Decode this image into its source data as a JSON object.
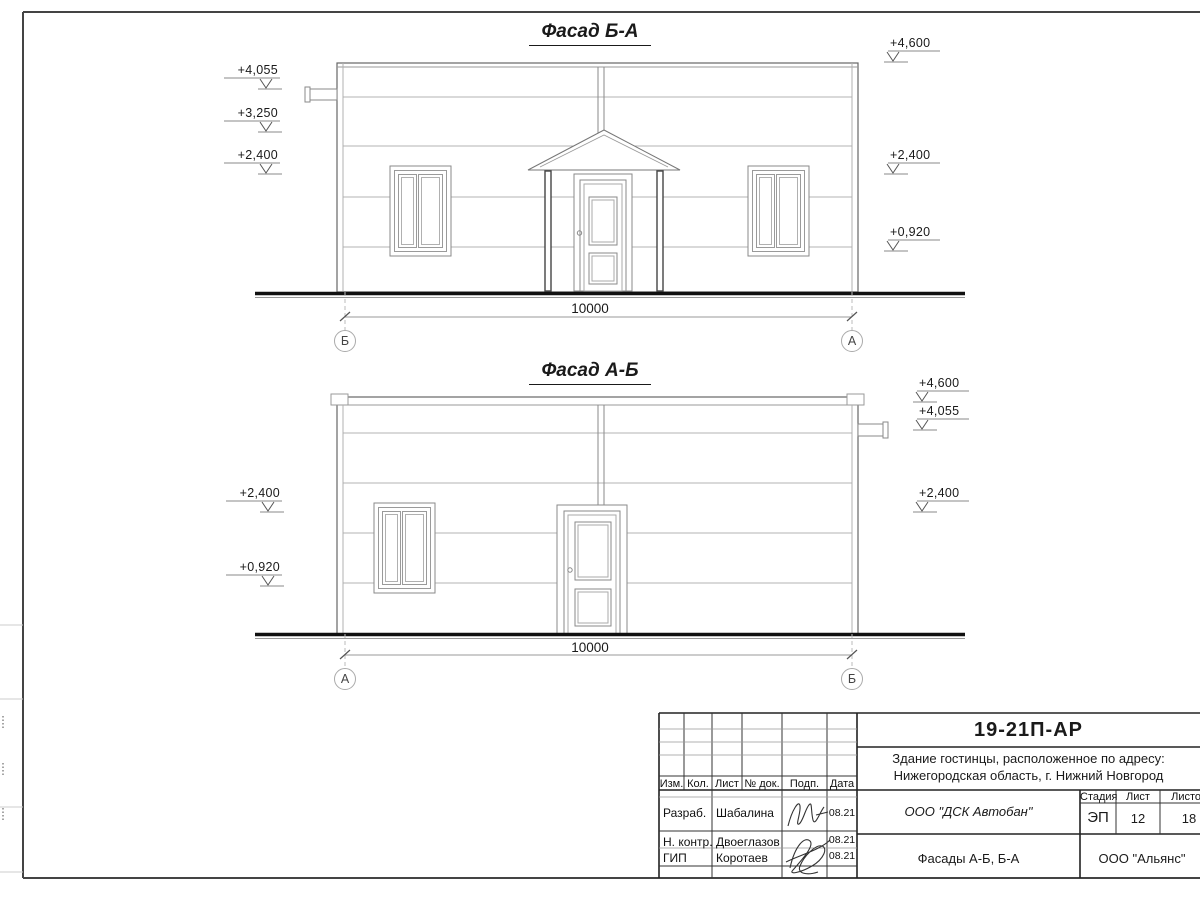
{
  "colors": {
    "ink": "#1a1a1a",
    "frame": "#444444",
    "siding_line": "#b3b3b3",
    "axis_circle": "#aaaaaa"
  },
  "facade_top": {
    "title": "Фасад Б-А",
    "dimension": "10000",
    "axis_left": "Б",
    "axis_right": "А",
    "elevations_left": [
      "+4,055",
      "+3,250",
      "+2,400"
    ],
    "elevations_right": [
      "+4,600",
      "+2,400",
      "+0,920"
    ]
  },
  "facade_bottom": {
    "title": "Фасад А-Б",
    "dimension": "10000",
    "axis_left": "А",
    "axis_right": "Б",
    "elevations_left": [
      "+2,400",
      "+0,920"
    ],
    "elevations_right": [
      "+4,600",
      "+4,055",
      "+2,400"
    ]
  },
  "title_block": {
    "doc_number": "19-21П-АР",
    "address_line1": "Здание гостинцы, расположенное по адресу:",
    "address_line2": "Нижегородская область, г. Нижний Новгород",
    "header_cols": [
      "Изм.",
      "Кол.",
      "Лист",
      "№ док.",
      "Подп.",
      "Дата"
    ],
    "rows": [
      {
        "role": "Разраб.",
        "name": "Шабалина",
        "date": "08.21"
      },
      {
        "role": "Н. контр.",
        "name": "Двоеглазов",
        "date": "08.21"
      },
      {
        "role": "ГИП",
        "name": "Коротаев",
        "date": "08.21"
      }
    ],
    "company": "ООО \"ДСК Автобан\"",
    "sheet_title": "Фасады А-Б, Б-А",
    "org": "ООО \"Альянс\"",
    "stage_label": "Стадия",
    "sheet_label": "Лист",
    "sheets_label": "Листов",
    "stage": "ЭП",
    "sheet": "12",
    "sheets": "18"
  }
}
